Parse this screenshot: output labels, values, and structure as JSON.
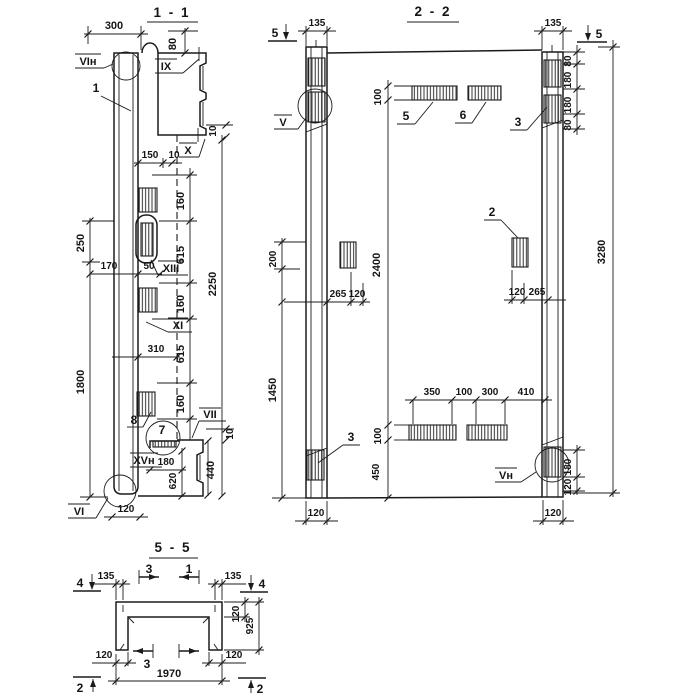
{
  "sheet": {
    "background": "#ffffff",
    "ink": "#1b1b1b"
  },
  "view_1_1": {
    "title": "1 - 1",
    "parts": {
      "p1": "1",
      "p7": "7",
      "p8": "8"
    },
    "details": {
      "vi_n": "VIн",
      "ix": "IX",
      "x": "X",
      "xiii": "XIII",
      "xi": "XI",
      "vii": "VII",
      "xv_n": "XVн",
      "vi": "VI"
    },
    "dims": {
      "w300": "300",
      "h80": "80",
      "w150": "150",
      "w10a": "10",
      "h160a": "160",
      "h615a": "615",
      "h160b": "160",
      "h615b": "615",
      "h160c": "160",
      "h2250": "2250",
      "h10t": "10",
      "h10b": "10",
      "h250": "250",
      "w170": "170",
      "w50": "50",
      "w310": "310",
      "h1800": "1800",
      "w180": "180",
      "h620": "620",
      "h440": "440",
      "w120": "120"
    }
  },
  "view_2_2": {
    "title": "2 - 2",
    "section_markers": {
      "s5l": "5",
      "s5r": "5"
    },
    "parts": {
      "p5": "5",
      "p6": "6",
      "p3top": "3",
      "p2": "2",
      "p3bot": "3"
    },
    "details": {
      "v": "V",
      "v_n": "Vн"
    },
    "dims": {
      "w135l": "135",
      "w135r": "135",
      "h100top": "100",
      "h2400": "2400",
      "h100bot": "100",
      "h450": "450",
      "h200": "200",
      "h1450": "1450",
      "w265l": "265",
      "w120l": "120",
      "w120r": "120",
      "w265r": "265",
      "h80a": "80",
      "h180a": "180",
      "h180b": "180",
      "h80b": "80",
      "h180c": "180",
      "h120c": "120",
      "h3280": "3280",
      "w350": "350",
      "w100": "100",
      "w300": "300",
      "w410": "410",
      "w120bl": "120",
      "w120br": "120"
    }
  },
  "view_5_5": {
    "title": "5 - 5",
    "section_markers": {
      "s4l": "4",
      "s4r": "4",
      "s3top": "3",
      "s1top": "1",
      "s3bot": "3",
      "s2l": "2",
      "s2r": "2"
    },
    "dims": {
      "w135l": "135",
      "w135r": "135",
      "h120web": "120",
      "h925": "925",
      "w120bl": "120",
      "w120br": "120",
      "w1970": "1970"
    }
  }
}
